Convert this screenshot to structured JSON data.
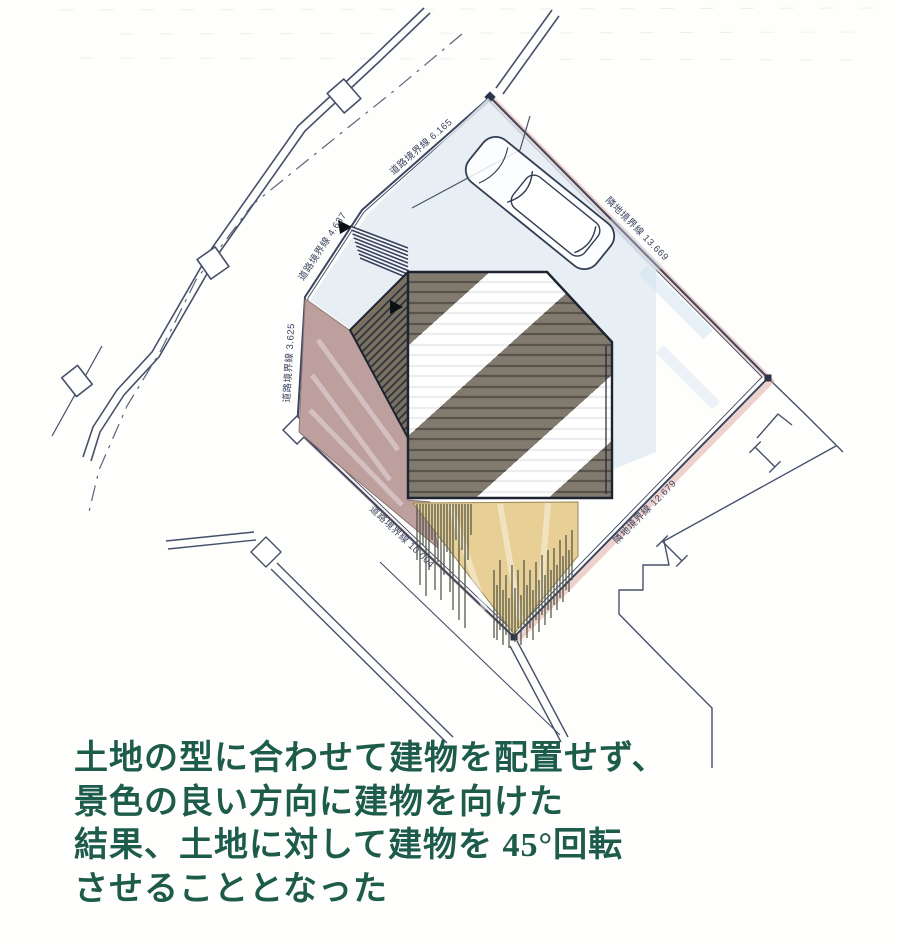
{
  "site_plan": {
    "boundary_labels": [
      {
        "id": "road-boundary-6165",
        "text": "道路境界線 6.165"
      },
      {
        "id": "road-boundary-4637",
        "text": "道路境界線 4.637"
      },
      {
        "id": "road-boundary-3625",
        "text": "道路境界線 3.625"
      },
      {
        "id": "road-boundary-10004",
        "text": "道路境界線 10.004"
      },
      {
        "id": "neighbor-boundary-13669",
        "text": "隣地境界線 13.669"
      },
      {
        "id": "neighbor-boundary-12679",
        "text": "隣地境界線 12.679"
      }
    ],
    "colors": {
      "line_ink": "#3d4660",
      "terrace_mauve": "#bd9f9e",
      "deck_tan": "#e8cf96",
      "driveway_blue": "#dfe9f2",
      "roof_shadow": "#5e5546",
      "caption_green": "#1d5b4a"
    }
  },
  "caption": {
    "color": "#1d5b4a",
    "lines": [
      "土地の型に合わせて建物を配置せず、",
      "景色の良い方向に建物を向けた",
      "結果、土地に対して建物を 45°回転",
      "させることとなった"
    ]
  }
}
